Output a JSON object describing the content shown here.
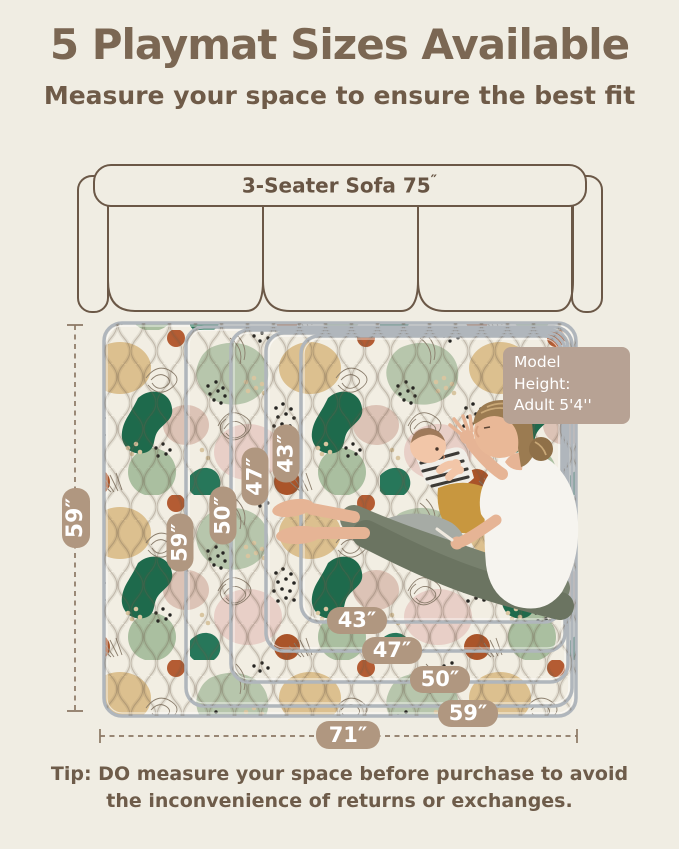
{
  "header": {
    "title": "5 Playmat Sizes Available",
    "subtitle": "Measure your space to ensure the best fit"
  },
  "sofa": {
    "label": "3-Seater Sofa 75",
    "inch_mark": "″"
  },
  "dimensions": {
    "overall_height": "59″",
    "overall_width": "71″",
    "height_badges": [
      "59″",
      "50″",
      "47″",
      "43″"
    ],
    "width_badges": [
      "43″",
      "47″",
      "50″",
      "59″"
    ]
  },
  "model_badge": {
    "line1": "Model Height:",
    "line2": "Adult  5'4''"
  },
  "tip": {
    "line1": "Tip: DO measure your space before purchase to avoid",
    "line2": "the inconvenience of returns or exchanges."
  },
  "colors": {
    "background": "#f0ede3",
    "heading_brown": "#7b6753",
    "badge_tan": "#b09780",
    "model_badge_tan": "#b7a294",
    "sofa_outline": "#6b5847",
    "mat_border_gray": "#b0b6bc",
    "mat_cream": "#f2eee3",
    "mat_dark_green": "#1e6a4c",
    "mat_sage": "#b7c6ac",
    "mat_tan": "#dcc08f",
    "mat_blush": "#e8cfc7",
    "mat_rust": "#aa5429"
  }
}
